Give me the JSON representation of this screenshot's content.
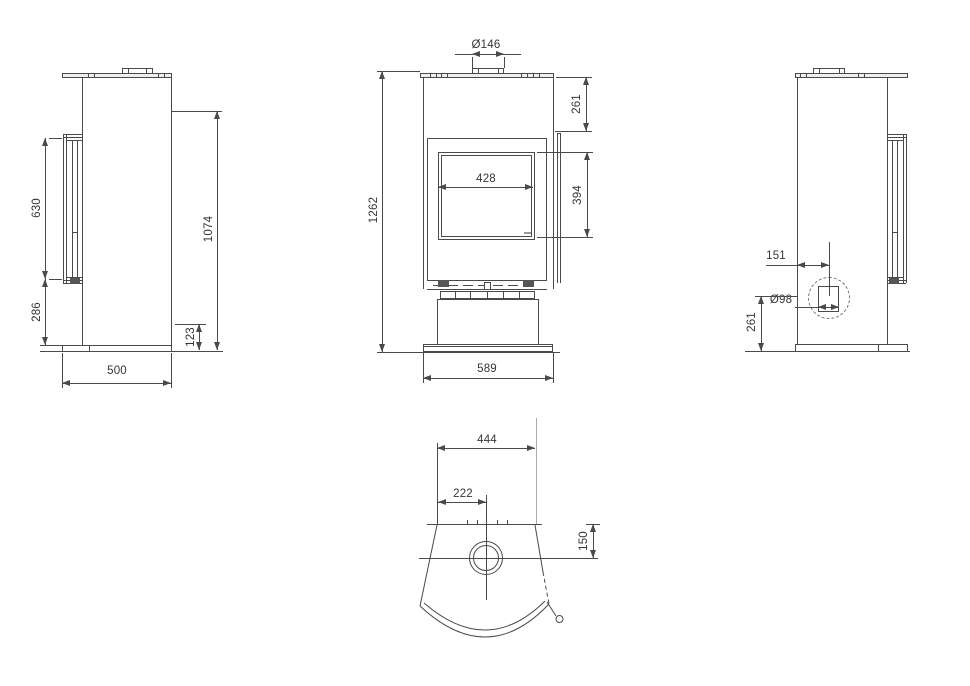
{
  "drawing": {
    "line_color": "#4a4a4a",
    "views": {
      "left_side": {
        "dims": {
          "door_height": "630",
          "door_bottom_to_base": "286",
          "rear_outlet_height": "1074",
          "base_height": "123",
          "depth": "500"
        }
      },
      "front": {
        "dims": {
          "flue_diameter": "Ø146",
          "top_to_glass": "261",
          "glass_width": "428",
          "glass_height": "394",
          "overall_height": "1262",
          "overall_width": "589"
        }
      },
      "right_side": {
        "dims": {
          "intake_offset_from_back": "151",
          "intake_diameter": "Ø98",
          "intake_center_height": "261"
        }
      },
      "top": {
        "dims": {
          "base_width": "444",
          "flue_center_offset": "222",
          "flue_center_from_back": "150"
        }
      }
    }
  }
}
